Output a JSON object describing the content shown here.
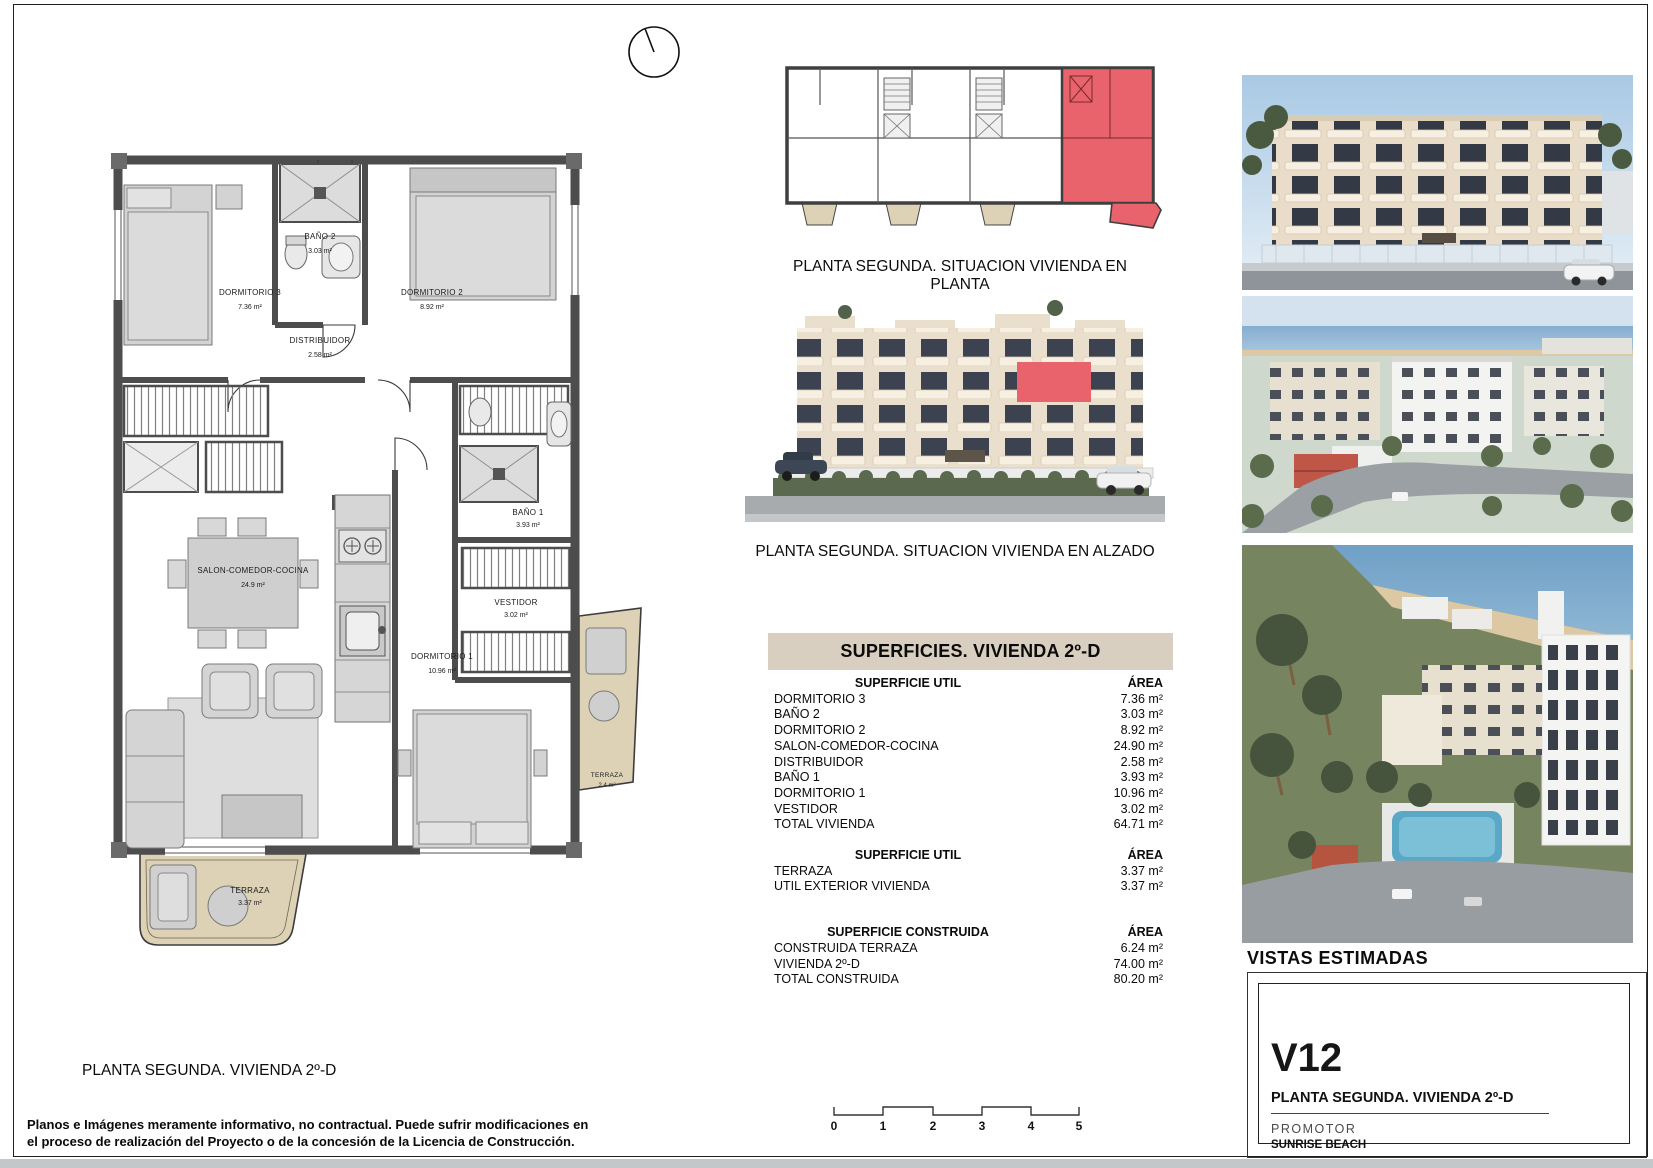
{
  "colors": {
    "highlight": "#e8636b",
    "terrace": "#ddd2b6",
    "table_header_bg": "#d9cfc0",
    "wall": "#4d4d4d"
  },
  "north_arrow": {
    "icon": "north-arrow-circle"
  },
  "floor_plan": {
    "caption": "PLANTA SEGUNDA. VIVIENDA 2º-D",
    "rooms": [
      {
        "name": "DORMITORIO 3",
        "area": "7.36 m²"
      },
      {
        "name": "BAÑO 2",
        "area": "3.03 m²"
      },
      {
        "name": "DORMITORIO 2",
        "area": "8.92 m²"
      },
      {
        "name": "DISTRIBUIDOR",
        "area": "2.58 m²"
      },
      {
        "name": "SALON-COMEDOR-COCINA",
        "area": "24.9 m²"
      },
      {
        "name": "BAÑO 1",
        "area": "3.93 m²"
      },
      {
        "name": "VESTIDOR",
        "area": "3.02 m²"
      },
      {
        "name": "DORMITORIO 1",
        "area": "10.96 m²"
      },
      {
        "name": "TERRAZA",
        "area": "3.37 m²"
      },
      {
        "name": "TERRAZA",
        "area": "2.4 m²"
      }
    ]
  },
  "key_plan": {
    "caption": "PLANTA SEGUNDA. SITUACION VIVIENDA EN PLANTA"
  },
  "elevation": {
    "caption": "PLANTA SEGUNDA. SITUACION VIVIENDA EN ALZADO"
  },
  "surfaces_table": {
    "title": "SUPERFICIES. VIVIENDA 2º-D",
    "sections": [
      {
        "header": "SUPERFICIE UTIL",
        "area_header": "ÁREA",
        "rows": [
          {
            "label": "DORMITORIO 3",
            "value": "7.36 m²"
          },
          {
            "label": "BAÑO 2",
            "value": "3.03 m²"
          },
          {
            "label": "DORMITORIO 2",
            "value": "8.92 m²"
          },
          {
            "label": "SALON-COMEDOR-COCINA",
            "value": "24.90 m²"
          },
          {
            "label": "DISTRIBUIDOR",
            "value": "2.58 m²"
          },
          {
            "label": "BAÑO 1",
            "value": "3.93 m²"
          },
          {
            "label": "DORMITORIO 1",
            "value": "10.96 m²"
          },
          {
            "label": "VESTIDOR",
            "value": "3.02 m²"
          },
          {
            "label": "TOTAL VIVIENDA",
            "value": "64.71 m²"
          }
        ]
      },
      {
        "header": "SUPERFICIE UTIL",
        "area_header": "ÁREA",
        "rows": [
          {
            "label": "TERRAZA",
            "value": "3.37 m²"
          },
          {
            "label": "UTIL EXTERIOR VIVIENDA",
            "value": "3.37 m²"
          }
        ]
      },
      {
        "header": "SUPERFICIE CONSTRUIDA",
        "area_header": "ÁREA",
        "rows": [
          {
            "label": "CONSTRUIDA TERRAZA",
            "value": "6.24 m²"
          },
          {
            "label": "VIVIENDA 2º-D",
            "value": "74.00 m²"
          },
          {
            "label": "TOTAL CONSTRUIDA",
            "value": "80.20 m²"
          }
        ]
      }
    ]
  },
  "views": {
    "heading": "VISTAS ESTIMADAS"
  },
  "title_block": {
    "code": "V12",
    "subtitle": "PLANTA SEGUNDA. VIVIENDA 2º-D",
    "promoter_label": "PROMOTOR",
    "promoter_name": "SUNRISE BEACH"
  },
  "disclaimer": {
    "line1": "Planos e Imágenes meramente informativo, no contractual. Puede sufrir modificaciones en",
    "line2": "el proceso de realización del Proyecto o de la concesión de la Licencia de Construcción."
  },
  "scale_bar": {
    "labels": [
      "0",
      "1",
      "2",
      "3",
      "4",
      "5"
    ]
  }
}
